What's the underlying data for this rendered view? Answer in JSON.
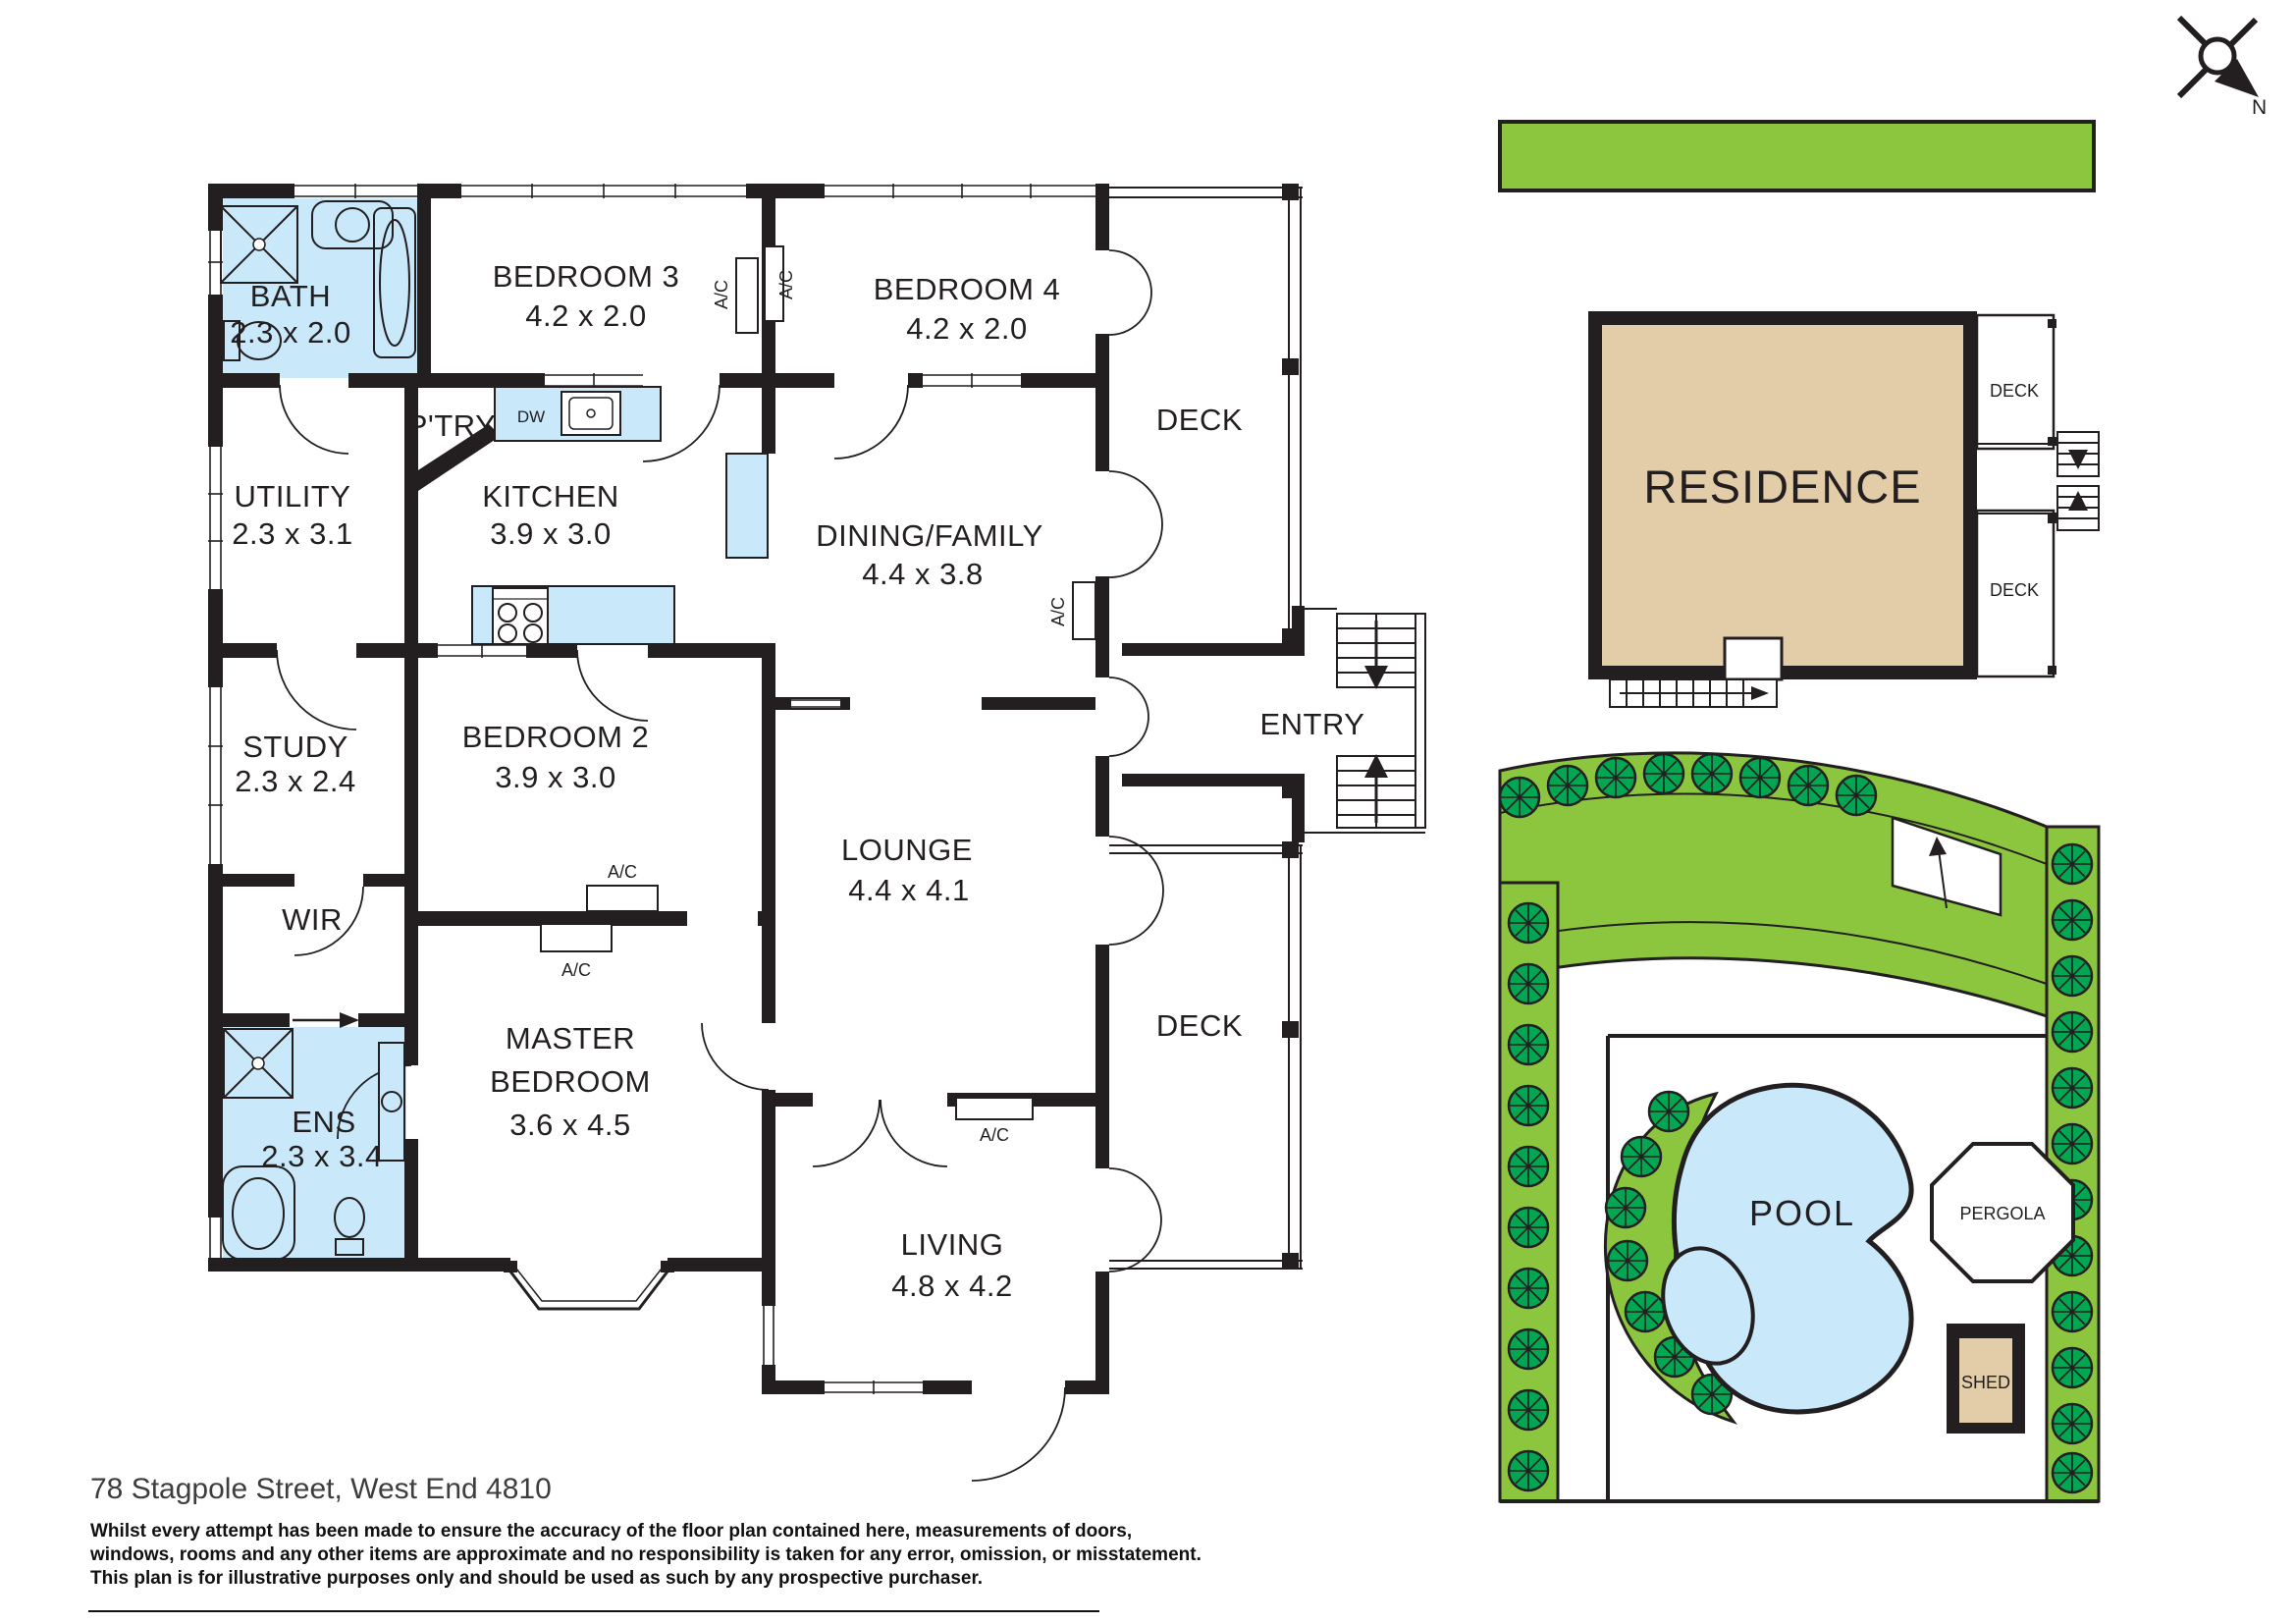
{
  "address": "78 Stagpole Street, West End 4810",
  "disclaimer_lines": [
    "Whilst every attempt has been made to ensure the accuracy of the floor plan contained here, measurements of doors,",
    "windows, rooms and any other items are approximate and no responsibility is taken for any error, omission, or misstatement.",
    "This plan is for illustrative purposes only and should be used as such by any prospective purchaser."
  ],
  "compass": {
    "north": "N"
  },
  "labels": {
    "ac": "A/C",
    "dw": "DW",
    "deck": "DECK",
    "entry": "ENTRY",
    "ptry": "P'TRY",
    "wir": "WIR"
  },
  "rooms": {
    "bath": {
      "name": "BATH",
      "dims": "2.3 x 2.0"
    },
    "bedroom3": {
      "name": "BEDROOM 3",
      "dims": "4.2 x 2.0"
    },
    "bedroom4": {
      "name": "BEDROOM 4",
      "dims": "4.2 x 2.0"
    },
    "utility": {
      "name": "UTILITY",
      "dims": "2.3 x 3.1"
    },
    "kitchen": {
      "name": "KITCHEN",
      "dims": "3.9 x 3.0"
    },
    "dining": {
      "name": "DINING/FAMILY",
      "dims": "4.4 x 3.8"
    },
    "study": {
      "name": "STUDY",
      "dims": "2.3 x 2.4"
    },
    "bedroom2": {
      "name": "BEDROOM 2",
      "dims": "3.9 x 3.0"
    },
    "lounge": {
      "name": "LOUNGE",
      "dims": "4.4 x 4.1"
    },
    "ens": {
      "name": "ENS",
      "dims": "2.3 x 3.4"
    },
    "master": {
      "line1": "MASTER",
      "line2": "BEDROOM",
      "dims": "3.6 x 4.5"
    },
    "living": {
      "name": "LIVING",
      "dims": "4.8 x 4.2"
    }
  },
  "siteplan": {
    "residence": "RESIDENCE",
    "pool": "POOL",
    "pergola": "PERGOLA",
    "shed": "SHED"
  },
  "colors": {
    "wall": "#231F20",
    "wet_blue": "#C9E8FA",
    "garden_green": "#8CC63E",
    "tree_green": "#00A651",
    "residence_tan": "#E3CDA9"
  }
}
